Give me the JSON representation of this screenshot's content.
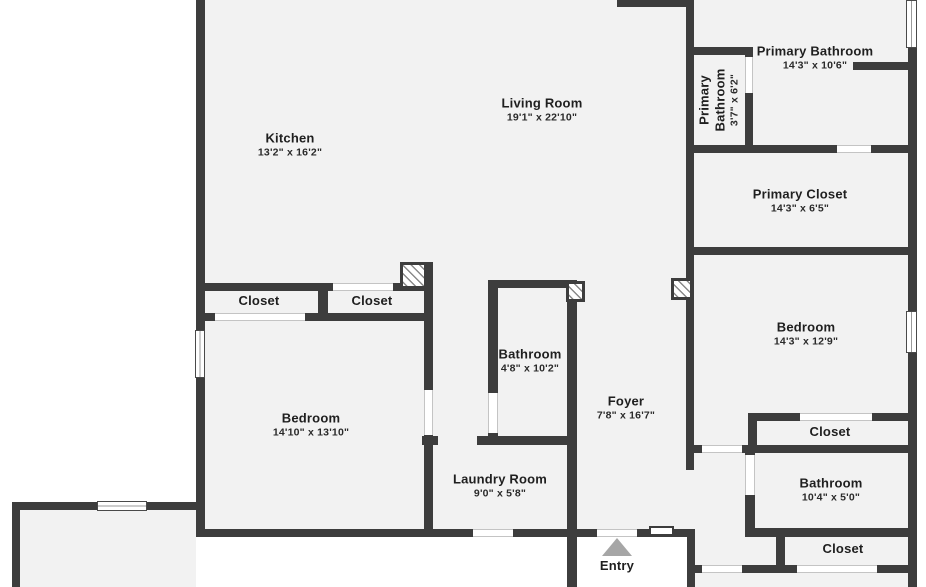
{
  "colors": {
    "wall": "#3d3d3d",
    "floor": "#f2f2f2",
    "outside": "#ffffff",
    "arrow": "#a6a6a6",
    "text": "#1f1f1f"
  },
  "rooms": [
    {
      "name": "Kitchen",
      "dims": "13'2\" x 16'2\""
    },
    {
      "name": "Living Room",
      "dims": "19'1\" x 22'10\""
    },
    {
      "name": "Primary Bathroom",
      "dims": "3'7\" x 6'2\""
    },
    {
      "name": "Primary Bathroom",
      "dims": "14'3\" x 10'6\""
    },
    {
      "name": "Primary Closet",
      "dims": "14'3\" x 6'5\""
    },
    {
      "name": "Closet",
      "dims": ""
    },
    {
      "name": "Closet",
      "dims": ""
    },
    {
      "name": "Bathroom",
      "dims": "4'8\" x 10'2\""
    },
    {
      "name": "Bedroom",
      "dims": "14'3\" x 12'9\""
    },
    {
      "name": "Bedroom",
      "dims": "14'10\" x 13'10\""
    },
    {
      "name": "Foyer",
      "dims": "7'8\" x 16'7\""
    },
    {
      "name": "Laundry Room",
      "dims": "9'0\" x 5'8\""
    },
    {
      "name": "Closet",
      "dims": ""
    },
    {
      "name": "Bathroom",
      "dims": "10'4\" x 5'0\""
    },
    {
      "name": "Closet",
      "dims": ""
    },
    {
      "name": "Entry",
      "dims": ""
    }
  ]
}
